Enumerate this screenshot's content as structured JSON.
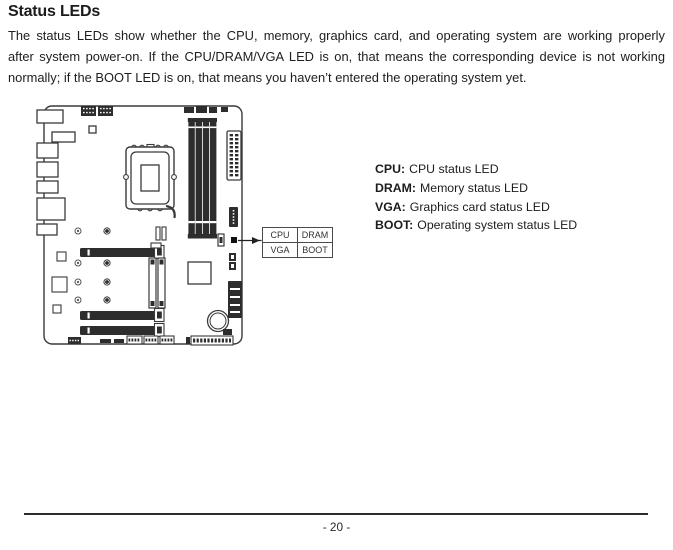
{
  "page": {
    "title": "Status LEDs",
    "page_number": "- 20 -"
  },
  "intro": {
    "lines": [
      "The status LEDs show whether the CPU, memory, graphics card, and operating system are working properly",
      "after system power-on. If the CPU/DRAM/VGA LED is on, that means the corresponding device is not working",
      "normally; if the BOOT LED is on, that means you haven’t entered the operating system yet."
    ]
  },
  "figure": {
    "callout": {
      "cells": [
        "CPU",
        "DRAM",
        "VGA",
        "BOOT"
      ]
    },
    "legend": [
      {
        "label": "CPU:",
        "text": "CPU status LED"
      },
      {
        "label": "DRAM:",
        "text": "Memory status LED"
      },
      {
        "label": "VGA:",
        "text": "Graphics card status LED"
      },
      {
        "label": "BOOT:",
        "text": "Operating system status LED"
      }
    ]
  },
  "colors": {
    "text": "#1e1e1e",
    "diagram_line": "#3a3a3a",
    "diagram_dark_fill": "#2d2d2d"
  }
}
